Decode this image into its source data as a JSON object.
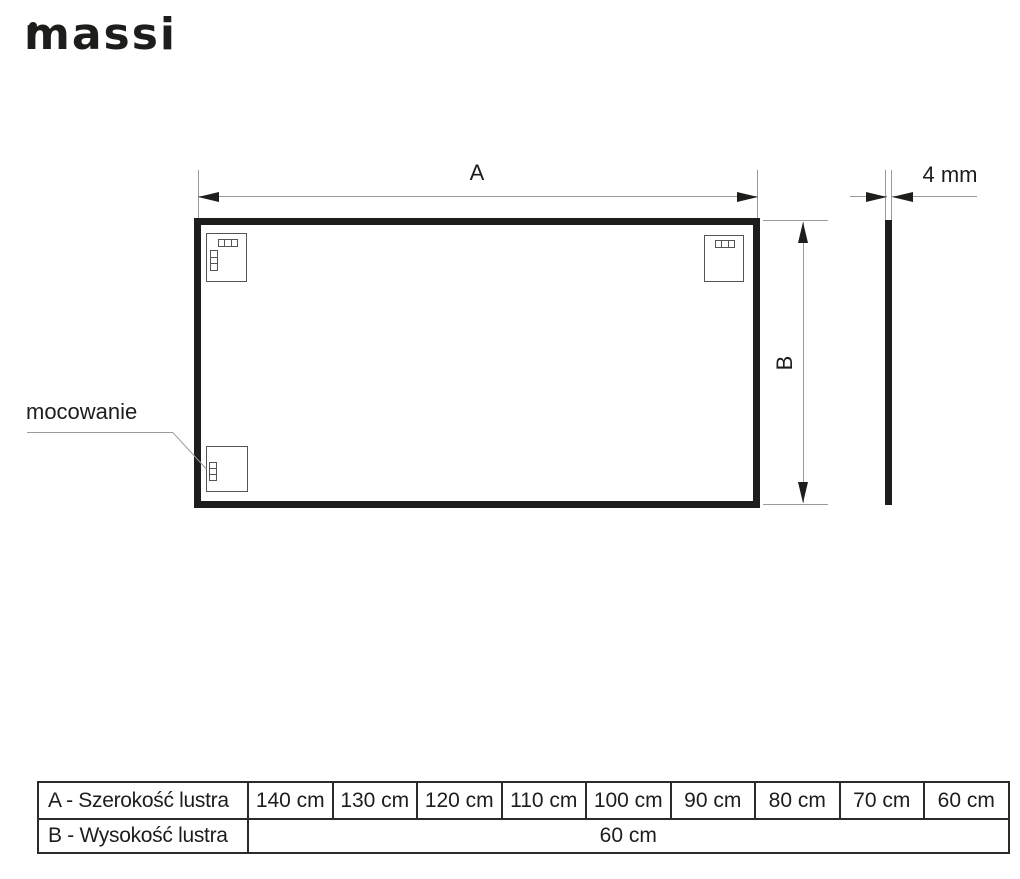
{
  "brand": {
    "logo_text": "massi"
  },
  "diagram": {
    "width_dimension_label": "A",
    "height_dimension_label": "B",
    "thickness_label": "4 mm",
    "mounting_label": "mocowanie"
  },
  "table": {
    "rows": [
      {
        "label": "A - Szerokość lustra",
        "values": [
          "140 cm",
          "130 cm",
          "120 cm",
          "110 cm",
          "100 cm",
          "90 cm",
          "80 cm",
          "70 cm",
          "60 cm"
        ]
      },
      {
        "label": "B - Wysokość lustra",
        "merged_value": "60 cm"
      }
    ]
  },
  "colors": {
    "ink": "#1d1d1b",
    "dimension_line": "#9a9a9a",
    "table_border": "#2b2b2b"
  }
}
